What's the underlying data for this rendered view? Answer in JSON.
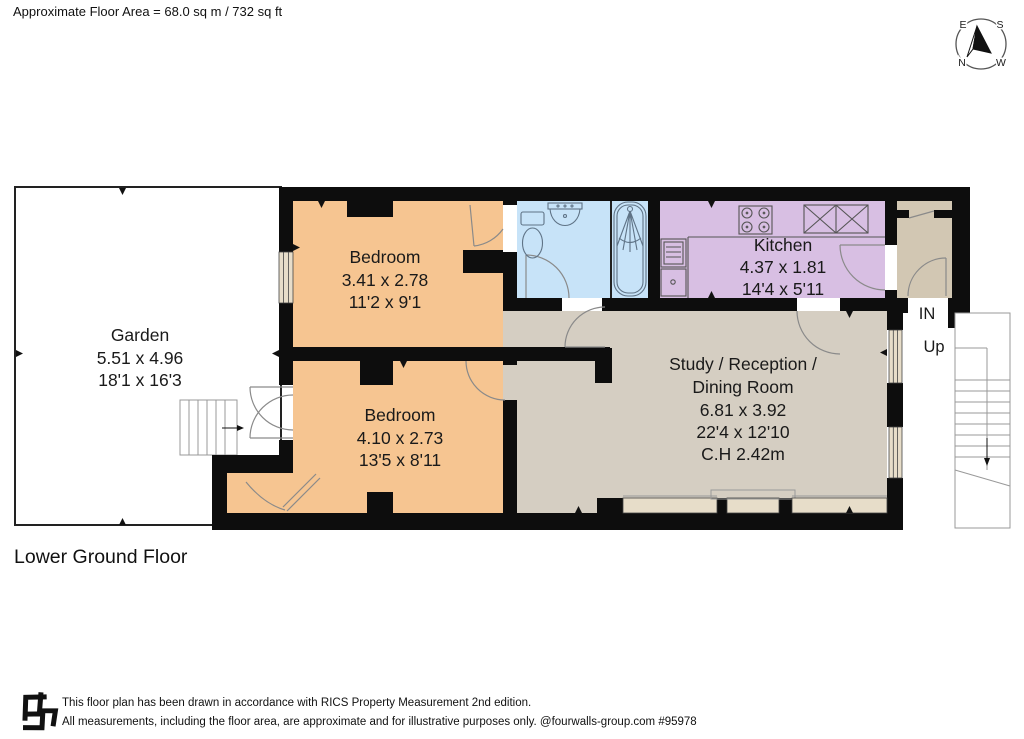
{
  "header": {
    "area_label": "Approximate Floor Area = 68.0 sq m / 732 sq ft"
  },
  "plan": {
    "floor_label": "Lower Ground Floor",
    "in_label": "IN",
    "up_label": "Up",
    "colors": {
      "wall": "#0d0d0d"
    },
    "rooms": {
      "garden": {
        "name": "Garden",
        "dims_m": "5.51 x 4.96",
        "dims_ft": "18'1 x 16'3",
        "color": "#ffffff"
      },
      "bedroom1": {
        "name": "Bedroom",
        "dims_m": "3.41 x 2.78",
        "dims_ft": "11'2 x 9'1",
        "color": "#f6c591"
      },
      "bedroom2": {
        "name": "Bedroom",
        "dims_m": "4.10 x 2.73",
        "dims_ft": "13'5 x 8'11",
        "color": "#f6c591"
      },
      "kitchen": {
        "name": "Kitchen",
        "dims_m": "4.37 x 1.81",
        "dims_ft": "14'4 x 5'11",
        "color": "#d8bfe3"
      },
      "study": {
        "name_line1": "Study / Reception /",
        "name_line2": "Dining Room",
        "dims_m": "6.81 x 3.92",
        "dims_ft": "22'4 x 12'10",
        "ceiling_height": "C.H 2.42m",
        "color": "#d5cec2"
      },
      "bathroom": {
        "color": "#c7e3f8"
      },
      "hall": {
        "color": "#d2c7b3"
      }
    }
  },
  "compass": {
    "east": "E",
    "south": "S",
    "north": "N",
    "west": "W"
  },
  "footer": {
    "line1": "This floor plan has been drawn in accordance with RICS Property Measurement 2nd edition.",
    "line2": "All measurements, including the floor area, are approximate and for illustrative purposes only. @fourwalls-group.com #95978"
  }
}
